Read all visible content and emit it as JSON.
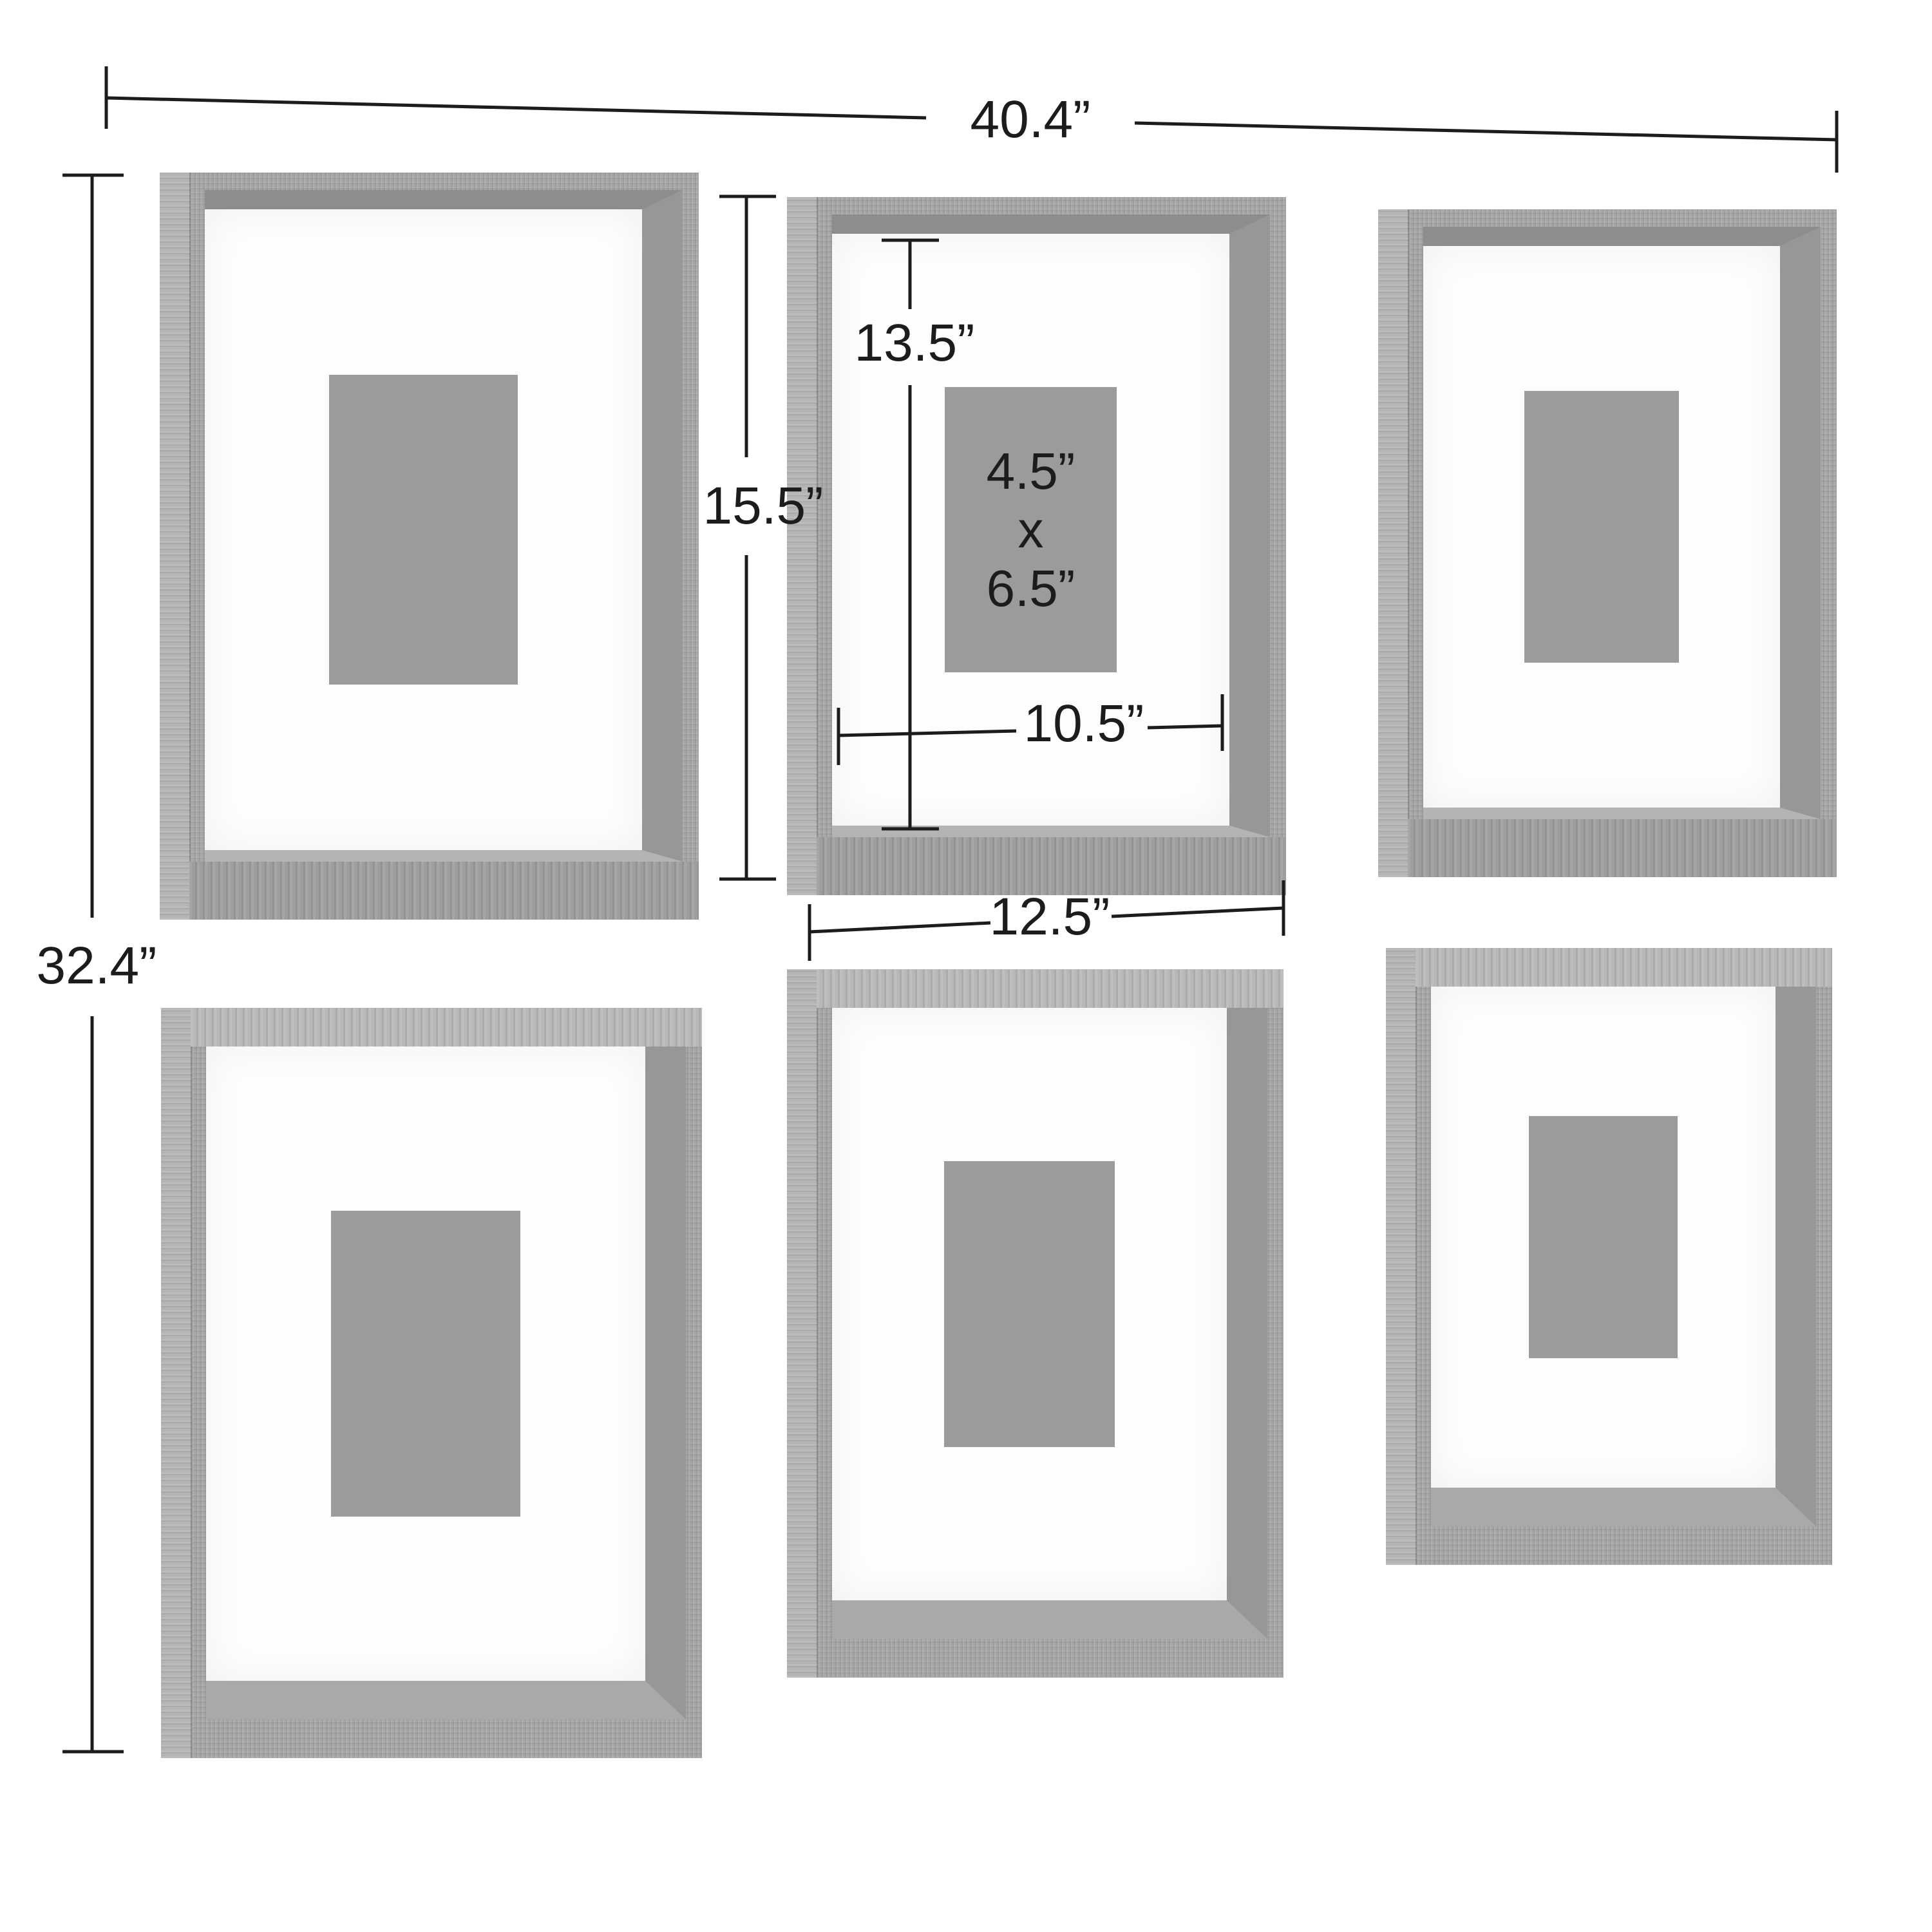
{
  "annotations": {
    "overall_width": "40.4”",
    "overall_height": "32.4”",
    "frame_height": "15.5”",
    "opening_top_offset": "13.5”",
    "mat_opening_width": "10.5”",
    "frame_width": "12.5”",
    "photo_size_line1": "4.5”",
    "photo_size_line2": "x",
    "photo_size_line3": "6.5”"
  },
  "colors": {
    "background": "#ffffff",
    "wood_face": "#a6a6a6",
    "wood_side": "#b4b4b4",
    "wood_wall_dark": "#8d8d8d",
    "wood_wall_mid": "#979797",
    "wood_top_face": "#b8b8b8",
    "wood_floor": "#a9a9a9",
    "mat": "#fdfdfd",
    "photo_placeholder": "#9b9b9b",
    "annotation": "#1c1c1c"
  }
}
